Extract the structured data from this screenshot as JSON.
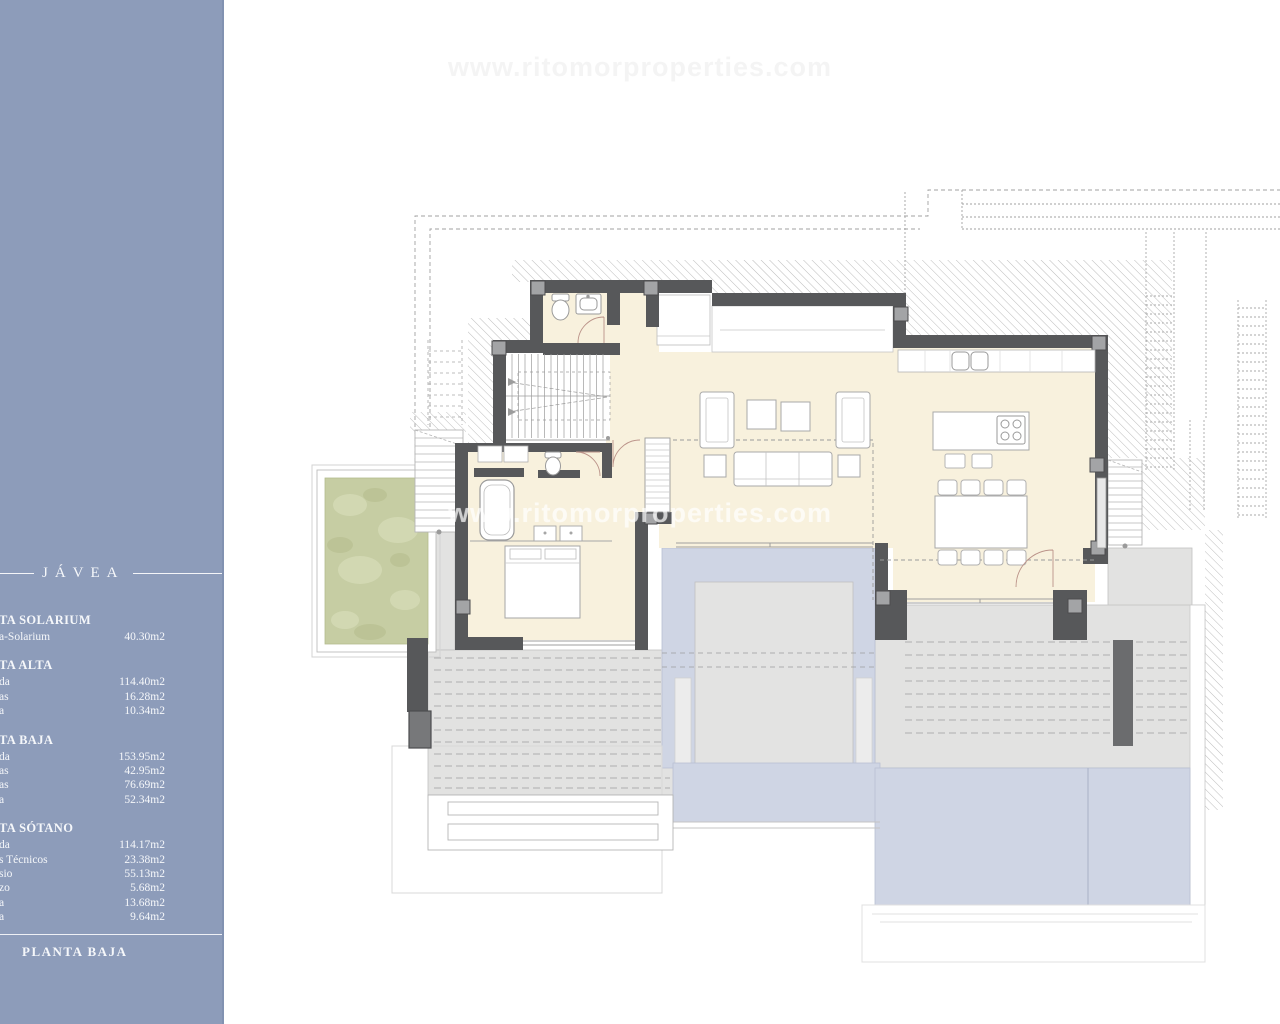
{
  "watermark": {
    "text": "www.ritomorproperties.com"
  },
  "sidebar": {
    "location_title": "JÁVEA",
    "footer_title": "PLANTA BAJA",
    "sections": [
      {
        "title": "TA SOLARIUM",
        "rows": [
          {
            "label": "a-Solarium",
            "value": "40.30m2"
          }
        ]
      },
      {
        "title": "TA ALTA",
        "rows": [
          {
            "label": "da",
            "value": "114.40m2"
          },
          {
            "label": "as",
            "value": "16.28m2"
          },
          {
            "label": "a",
            "value": "10.34m2"
          }
        ]
      },
      {
        "title": "TA BAJA",
        "rows": [
          {
            "label": "da",
            "value": "153.95m2"
          },
          {
            "label": "as",
            "value": "42.95m2"
          },
          {
            "label": "as",
            "value": "76.69m2"
          },
          {
            "label": "a",
            "value": "52.34m2"
          }
        ]
      },
      {
        "title": "TA SÓTANO",
        "rows": [
          {
            "label": "da",
            "value": "114.17m2"
          },
          {
            "label": "s Técnicos",
            "value": "23.38m2"
          },
          {
            "label": "sio",
            "value": "55.13m2"
          },
          {
            "label": "zo",
            "value": "5.68m2"
          },
          {
            "label": "a",
            "value": "13.68m2"
          },
          {
            "label": "a",
            "value": "9.64m2"
          }
        ]
      }
    ]
  },
  "colors": {
    "sidebar_blue": "#8d9cba",
    "floor_cream": "#f8f1dd",
    "wall_dark": "#57585a",
    "terrace_gray": "#e2e2e1",
    "pool_blue": "#cfd5e4",
    "garden_green": "#c6cda3",
    "hatch_gray": "#bcbcbc"
  }
}
